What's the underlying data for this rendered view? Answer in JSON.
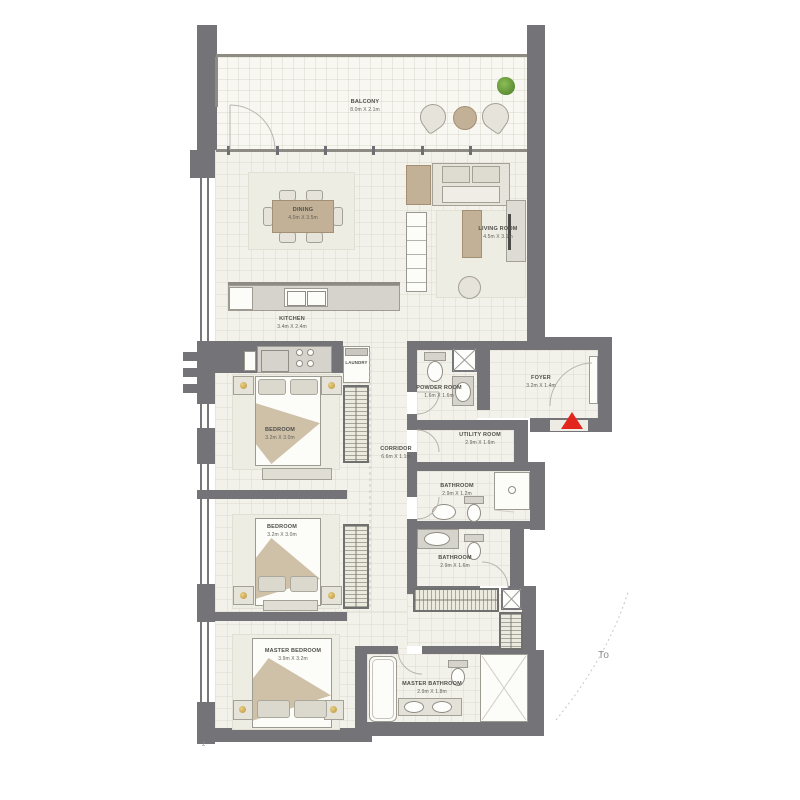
{
  "rooms": {
    "balcony": {
      "name": "BALCONY",
      "dims": "8.0m X 2.1m"
    },
    "dining": {
      "name": "DINING",
      "dims": "4.0m X 3.5m"
    },
    "living_room": {
      "name": "LIVING ROOM",
      "dims": "4.5m X 3.1m"
    },
    "kitchen": {
      "name": "KITCHEN",
      "dims": "3.4m X 2.4m"
    },
    "laundry": {
      "name": "LAUNDRY"
    },
    "powder_room": {
      "name": "POWDER ROOM",
      "dims": "1.6m X 1.6m"
    },
    "foyer": {
      "name": "FOYER",
      "dims": "3.2m X 1.4m"
    },
    "utility_room": {
      "name": "UTILITY ROOM",
      "dims": "2.9m X 1.6m"
    },
    "corridor": {
      "name": "CORRIDOR",
      "dims": "6.6m X 1.1m"
    },
    "bedroom_1": {
      "name": "BEDROOM",
      "dims": "3.2m X 3.0m"
    },
    "bedroom_2": {
      "name": "BEDROOM",
      "dims": "3.2m X 3.0m"
    },
    "bathroom_1": {
      "name": "BATHROOM",
      "dims": "2.9m X 1.2m"
    },
    "bathroom_2": {
      "name": "BATHROOM",
      "dims": "2.9m X 1.6m"
    },
    "master_bedroom": {
      "name": "MASTER BEDROOM",
      "dims": "3.9m X 3.2m"
    },
    "master_bathroom": {
      "name": "MASTER BATHROOM",
      "dims": "2.9m X 1.8m"
    }
  },
  "annotations": {
    "truncated_note": "To",
    "sheet_mark": "2"
  },
  "colors": {
    "wall": "#747478",
    "floor": "#f2f1ea",
    "balcony_floor": "#f8f7f2",
    "wood": "#c3b197",
    "entry_marker_red": "#e3261d",
    "plant_green": "#76a93f",
    "gold_accent": "#c8a84b"
  }
}
